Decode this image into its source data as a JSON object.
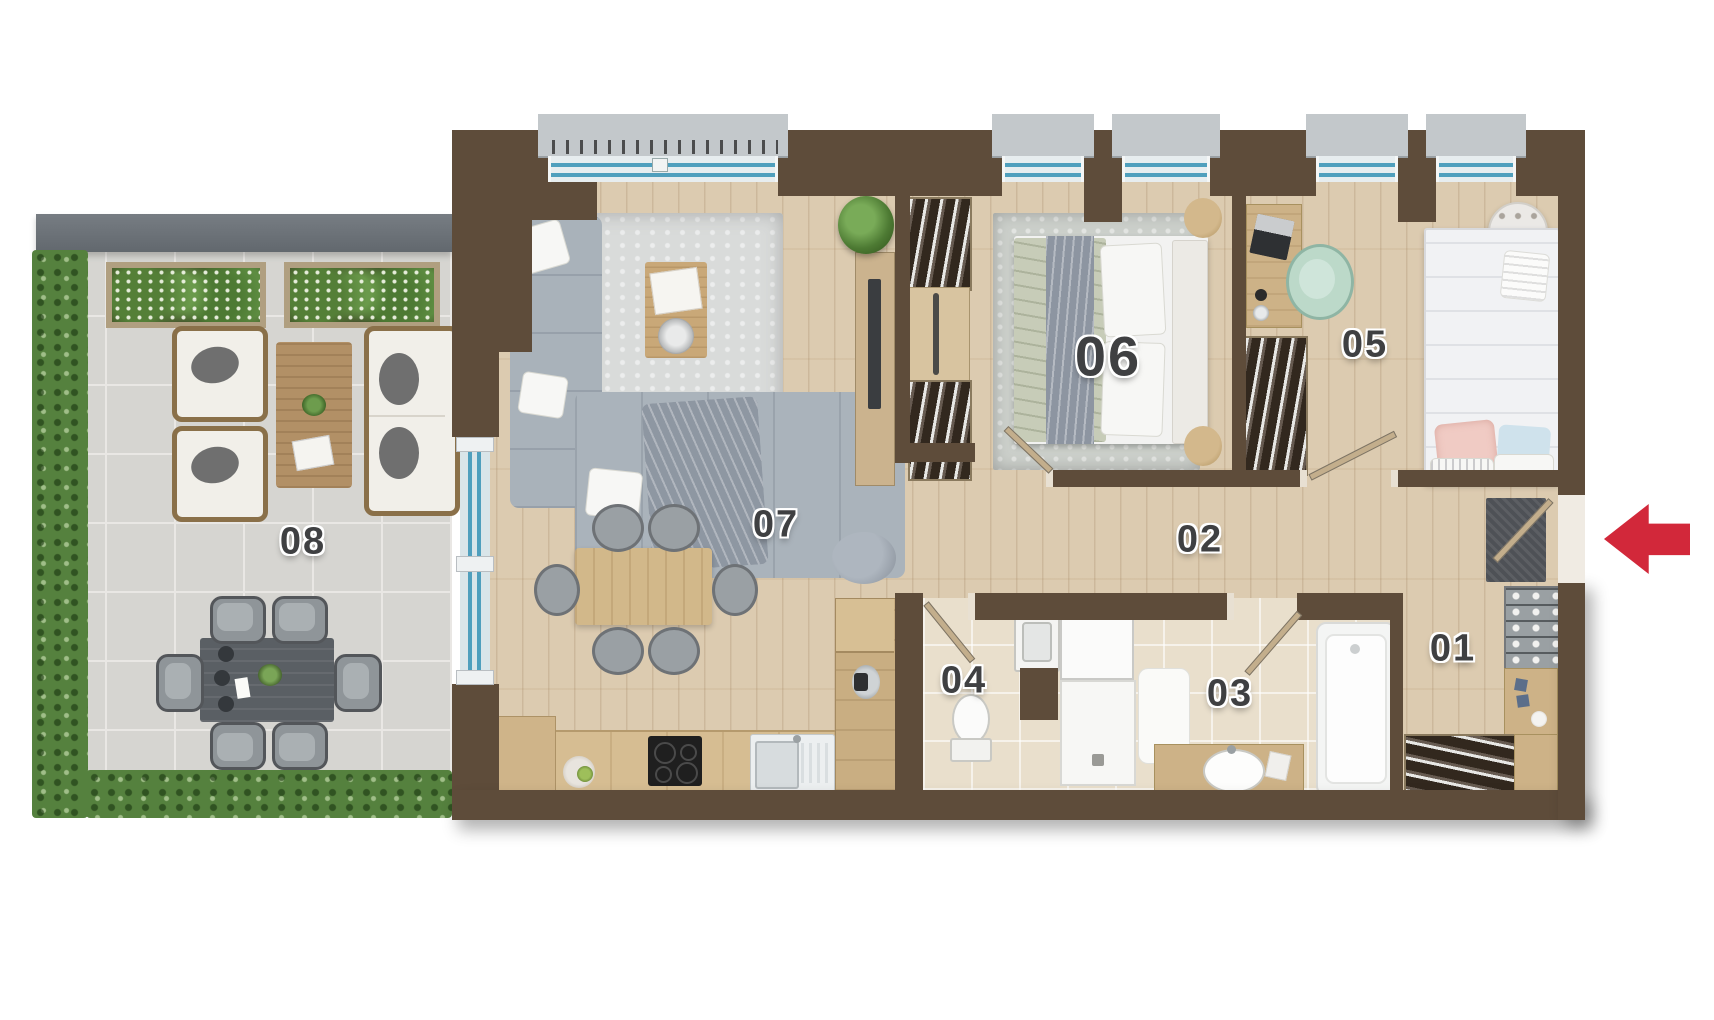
{
  "scene": {
    "type": "apartment-floor-plan-3d-top-view"
  },
  "rooms": [
    {
      "number": "01",
      "name": "entrance-hall",
      "furniture": [
        "doormat",
        "entrance-door",
        "shoe-rack",
        "side-cabinet",
        "coat-wardrobe"
      ]
    },
    {
      "number": "02",
      "name": "hallway",
      "furniture": []
    },
    {
      "number": "03",
      "name": "bathroom",
      "furniture": [
        "walk-in-shower",
        "bath-mat",
        "vanity-sink",
        "bathtub"
      ]
    },
    {
      "number": "04",
      "name": "wc",
      "furniture": [
        "toilet",
        "hand-basin"
      ]
    },
    {
      "number": "05",
      "name": "bedroom-small",
      "furniture": [
        "desk",
        "laptop",
        "office-chair",
        "wardrobe",
        "round-pouf",
        "single-bed"
      ]
    },
    {
      "number": "06",
      "name": "bedroom-master",
      "furniture": [
        "double-bed",
        "rug",
        "two-wardrobes",
        "two-round-nightstands",
        "tv-panel"
      ]
    },
    {
      "number": "07",
      "name": "living-room-with-kitchen",
      "furniture": [
        "corner-sofa",
        "rug",
        "coffee-table",
        "tv-sideboard",
        "plant",
        "pouf",
        "dining-table",
        "six-chairs",
        "kitchen-counter",
        "cooktop",
        "kitchen-sink",
        "tall-kitchen-unit",
        "fruit-bowl"
      ]
    },
    {
      "number": "08",
      "name": "terrace",
      "furniture": [
        "hedge",
        "planter-boxes",
        "two-armchairs",
        "coffee-table",
        "outdoor-sofa",
        "outdoor-dining-table",
        "six-outdoor-chairs"
      ]
    }
  ],
  "entrance": {
    "arrow_icon": "arrow-left",
    "color": "#d2283a"
  },
  "palette": {
    "wall": "#5e4c3a",
    "wood_floor": "#dccbb0",
    "bath_tile": "#e9dfcc",
    "terrace_tile": "#d6d5d1",
    "parapet": "#6b7177",
    "hedge": "#55813e",
    "window_glass": "#4f9fbd",
    "label_text": "#3f4042"
  }
}
